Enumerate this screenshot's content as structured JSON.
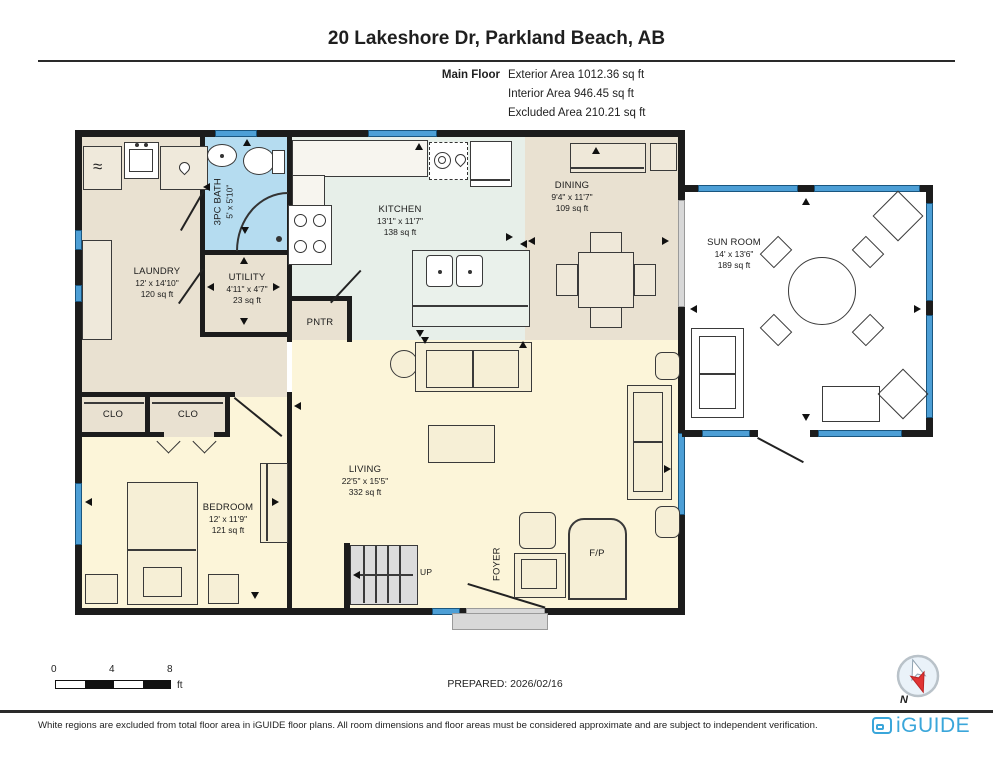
{
  "header": {
    "title": "20 Lakeshore Dr, Parkland Beach, AB",
    "floor_label": "Main Floor",
    "stats": [
      "Exterior Area 1012.36 sq ft",
      "Interior Area 946.45 sq ft",
      "Excluded Area 210.21 sq ft"
    ]
  },
  "rooms": {
    "laundry": {
      "name": "LAUNDRY",
      "dims": "12' x 14'10\"",
      "area": "120 sq ft"
    },
    "bath": {
      "name": "3PC BATH",
      "dims": "5' x 5'10\""
    },
    "utility": {
      "name": "UTILITY",
      "dims": "4'11\" x 4'7\"",
      "area": "23 sq ft"
    },
    "kitchen": {
      "name": "KITCHEN",
      "dims": "13'1\" x 11'7\"",
      "area": "138 sq ft"
    },
    "dining": {
      "name": "DINING",
      "dims": "9'4\" x 11'7\"",
      "area": "109 sq ft"
    },
    "sunroom": {
      "name": "SUN ROOM",
      "dims": "14' x 13'6\"",
      "area": "189 sq ft"
    },
    "living": {
      "name": "LIVING",
      "dims": "22'5\" x 15'5\"",
      "area": "332 sq ft"
    },
    "bedroom": {
      "name": "BEDROOM",
      "dims": "12' x 11'9\"",
      "area": "121 sq ft"
    }
  },
  "small": {
    "pantry": "PNTR",
    "closet": "CLO",
    "foyer": "FOYER",
    "up": "UP",
    "fireplace": "F/P"
  },
  "icons": {
    "washer": "≈"
  },
  "scalebar": {
    "ticks": [
      "0",
      "4",
      "8"
    ],
    "unit": "ft"
  },
  "prepared": "PREPARED: 2026/02/16",
  "compass": {
    "label": "N"
  },
  "footer": {
    "disclaimer": "White regions are excluded from total floor area in iGUIDE floor plans. All room dimensions and floor areas must be considered approximate and are subject to independent verification.",
    "brand": "iGUIDE"
  },
  "colors": {
    "wall": "#1c1c1c",
    "window_blue": "#4d9fd6",
    "bath_blue": "#b5dcf0",
    "floor_tan": "#e9e1d1",
    "floor_green": "#e7efe9",
    "floor_yellow": "#fcf5d9",
    "brand_blue": "#3aa6da",
    "compass_red": "#e03434"
  }
}
